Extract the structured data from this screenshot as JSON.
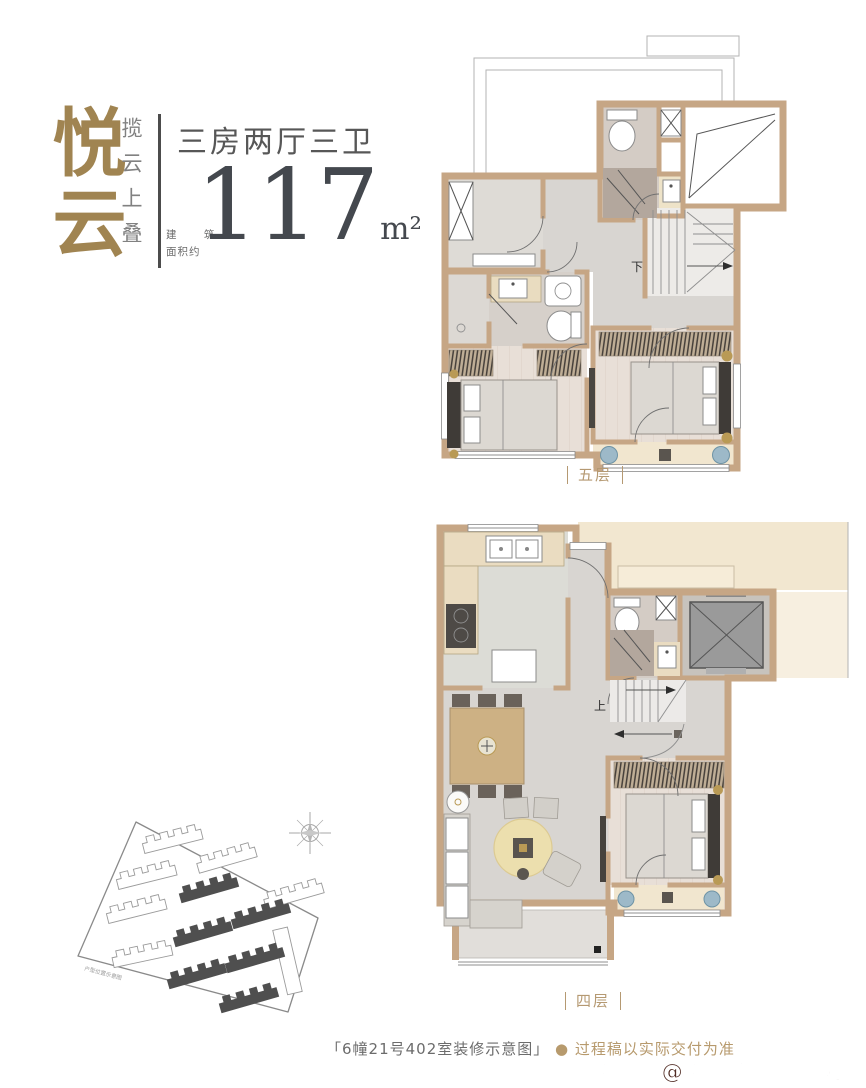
{
  "header": {
    "brand_vertical": "悦云",
    "tagline_vertical": "揽云上叠",
    "unit_type": "三房两厅三卫",
    "area_label_line1": "建 筑",
    "area_label_line2": "面积约",
    "area_value": "117",
    "area_unit": "m²"
  },
  "floor_plans": {
    "upper": {
      "label": "五层",
      "stair_direction": "下"
    },
    "lower": {
      "label": "四层",
      "stair_direction": "上"
    }
  },
  "site_plan": {
    "note": "户型位置示意图"
  },
  "footer": {
    "caption": "「6幢21号402室装修示意图」",
    "bullet": "●",
    "disclaimer": "过程稿以实际交付为准",
    "watermark": "搜狐号@搜狐焦点嘉峪关站"
  },
  "colors": {
    "brand_gold": "#a08451",
    "label_gold": "#b59972",
    "text_gray": "#575757",
    "area_number": "#44484e",
    "wall_tan": "#c6a685",
    "cream_exterior": "#f2e7d0",
    "elevator_gray": "#9a9a9a",
    "rug_yellow": "#ecdfae",
    "plant_blue": "#9db9c8",
    "watermark_red": "#4f2a22"
  }
}
